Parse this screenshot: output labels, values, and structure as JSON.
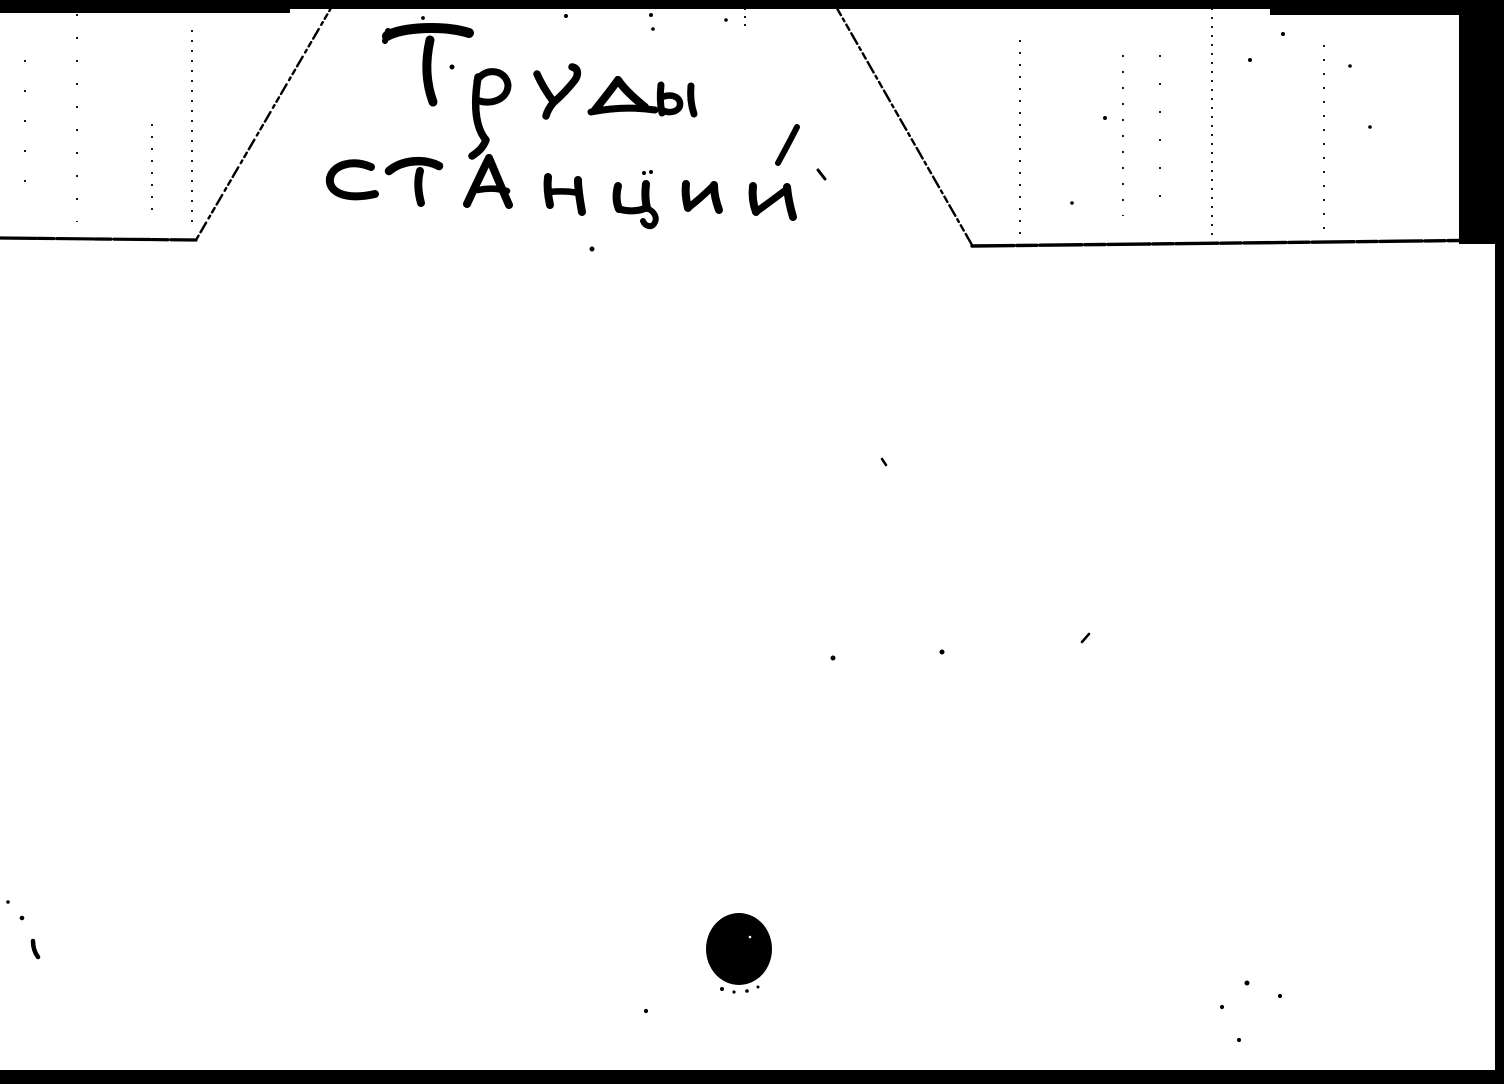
{
  "scan": {
    "description": "Scanned handwritten library catalog divider card with top tab, punch hole and black scanner edges",
    "tab": {
      "text": "Труды станций",
      "line1": "Труды",
      "line2": "станций",
      "accent_note": "stress mark over й"
    },
    "card_body_text": "",
    "hole_icon": "punched-hole",
    "colors": {
      "ink": "#000000",
      "paper": "#ffffff",
      "scan_edge": "#000000"
    }
  }
}
